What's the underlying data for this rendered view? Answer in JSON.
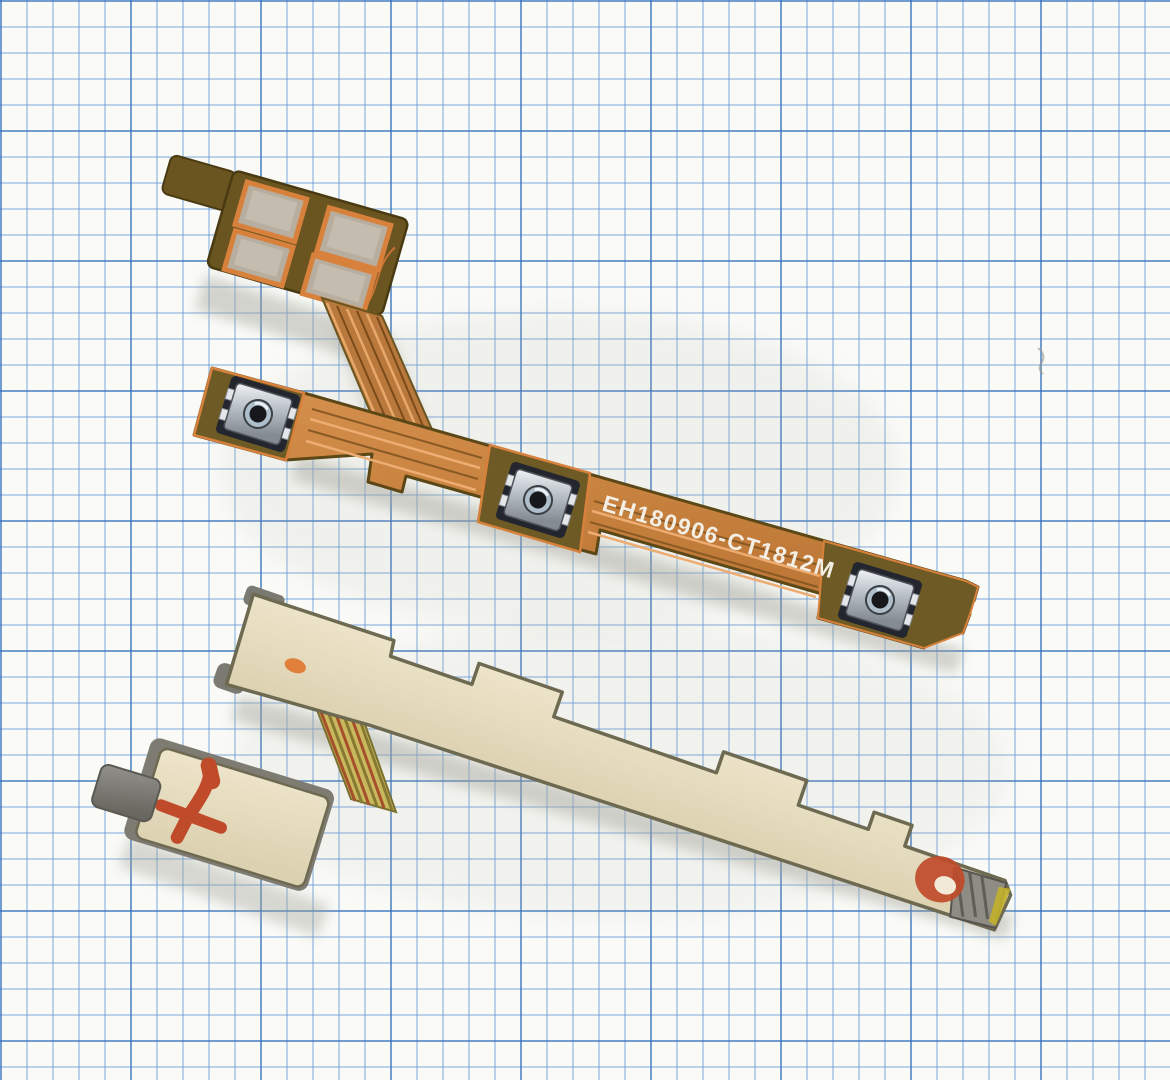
{
  "photo": {
    "subject": "Macro photo of a phone power/volume flex cable (front copper side and back adhesive side) lying on blue millimeter graph paper",
    "marking_text": "EH180906-CT1812M",
    "components": {
      "tactile_switches": 3,
      "connector_pads": 4,
      "red_ink_marks": 2
    },
    "colors": {
      "paper_white": "#fafbf7",
      "grid_minor_blue": "#6096d6",
      "grid_major_blue": "#2d69b4",
      "copper_trace": "#d28a4a",
      "substrate_olive": "#6e5a22",
      "pad_rim_orange": "#d8813c",
      "adhesive_beige": "#e7ddc1",
      "switch_metal": "#c7cdd3",
      "red_ink": "#bf4b2a"
    }
  }
}
